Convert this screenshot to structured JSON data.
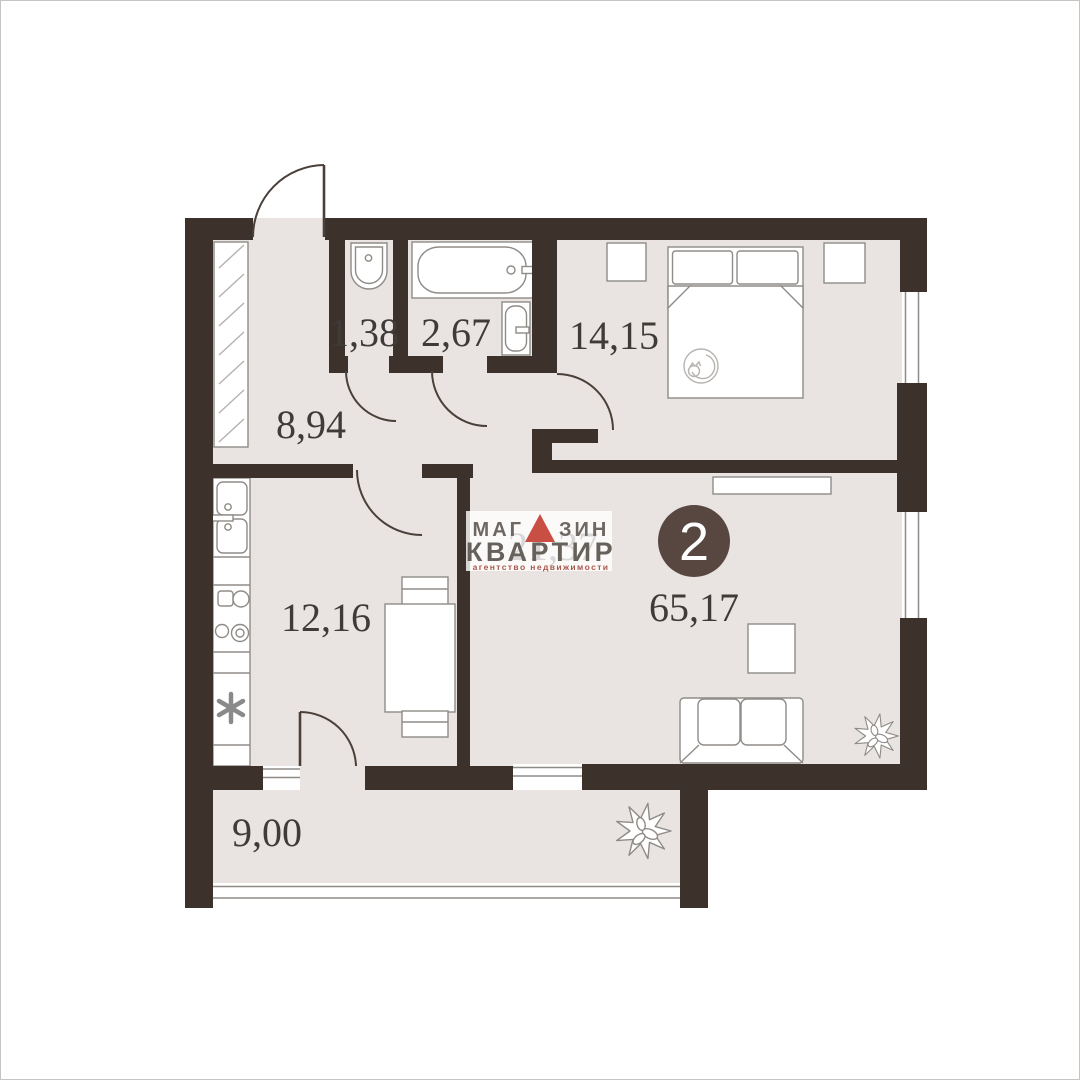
{
  "plan": {
    "type": "apartment-floor-plan",
    "rooms_badge": "2",
    "areas": {
      "toilet": "1,38",
      "bathroom": "2,67",
      "bedroom": "14,15",
      "hallway": "8,94",
      "kitchen": "12,16",
      "living_room": "21,37",
      "total": "65,17",
      "balcony": "9,00"
    },
    "colors": {
      "wall": "#3d322b",
      "floor": "#e9e4e1",
      "badge": "#574740",
      "logo_accent_red": "#c94f44",
      "logo_text": "#6b6460",
      "label_text": "#3f3b38"
    }
  },
  "logo": {
    "line1_prefix": "МАГ",
    "line1_suffix": "ЗИН",
    "line2": "КВАРТИР",
    "tagline": "агентство недвижимости"
  }
}
